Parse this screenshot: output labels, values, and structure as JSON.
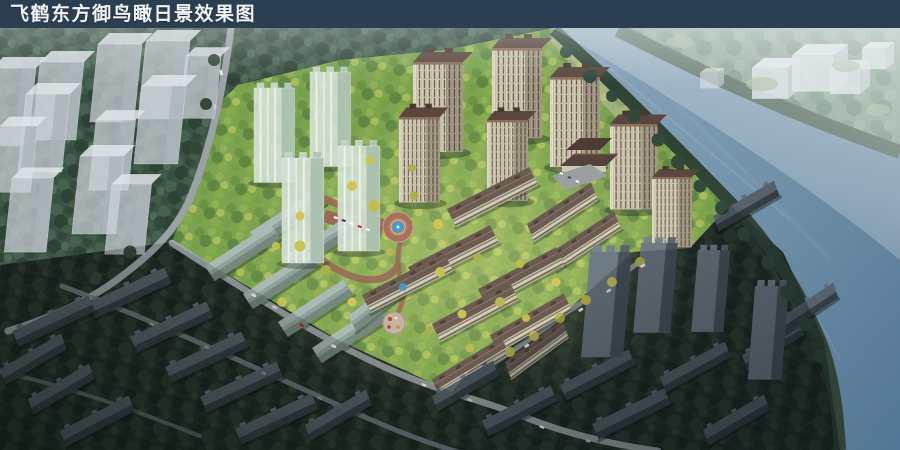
{
  "header": {
    "title": "飞鹤东方御鸟瞰日景效果图"
  },
  "colors": {
    "title_bar_bg": "#2c3f52",
    "title_text": "#f2f5f7",
    "river_water": "#6d8ca6",
    "forest_green": "#3d5345",
    "forest_dark": "#242f28",
    "park_green": "#7ca34f",
    "autumn_tree_yellow": "#d2c455",
    "facade_cream": "#d9d2c0",
    "roof_brown": "#5a463c",
    "glass_tower_mint": "#d6e4d8",
    "ghost_block_gray": "#ccd3d9",
    "road_gray": "#9aa0a3",
    "plaza_paving_red": "#a5715b",
    "fountain_blue": "#3f9fd0",
    "shadow_building_gray": "#57616a",
    "haze_white": "#e8eef0"
  }
}
